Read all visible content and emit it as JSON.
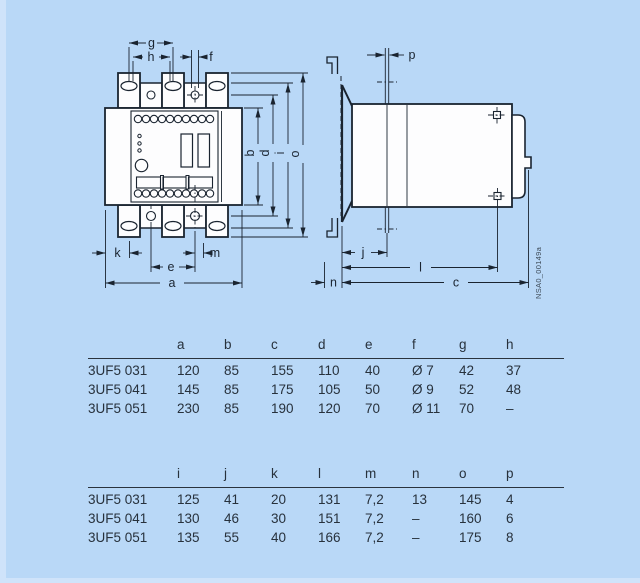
{
  "figure": {
    "annotation": "NSA0_00149a"
  },
  "labels": {
    "a": "a",
    "b": "b",
    "c": "c",
    "d": "d",
    "e": "e",
    "f": "f",
    "g": "g",
    "h": "h",
    "i": "i",
    "j": "j",
    "k": "k",
    "l": "l",
    "m": "m",
    "n": "n",
    "o": "o",
    "p": "p"
  },
  "tables": [
    {
      "columns": [
        "a",
        "b",
        "c",
        "d",
        "e",
        "f",
        "g",
        "h"
      ],
      "rows": [
        {
          "model": "3UF5 031",
          "values": [
            "120",
            "85",
            "155",
            "110",
            "40",
            "Ø 7",
            "42",
            "37"
          ]
        },
        {
          "model": "3UF5 041",
          "values": [
            "145",
            "85",
            "175",
            "105",
            "50",
            "Ø 9",
            "52",
            "48"
          ]
        },
        {
          "model": "3UF5 051",
          "values": [
            "230",
            "85",
            "190",
            "120",
            "70",
            "Ø 11",
            "70",
            "–"
          ]
        }
      ]
    },
    {
      "columns": [
        "i",
        "j",
        "k",
        "l",
        "m",
        "n",
        "o",
        "p"
      ],
      "rows": [
        {
          "model": "3UF5 031",
          "values": [
            "125",
            "41",
            "20",
            "131",
            "7,2",
            "13",
            "145",
            "4"
          ]
        },
        {
          "model": "3UF5 041",
          "values": [
            "130",
            "46",
            "30",
            "151",
            "7,2",
            "–",
            "160",
            "6"
          ]
        },
        {
          "model": "3UF5 051",
          "values": [
            "135",
            "55",
            "40",
            "166",
            "7,2",
            "–",
            "175",
            "8"
          ]
        }
      ]
    }
  ],
  "colors": {
    "background": "#b9d8f7",
    "line": "#1a2430",
    "text": "#27313c"
  }
}
